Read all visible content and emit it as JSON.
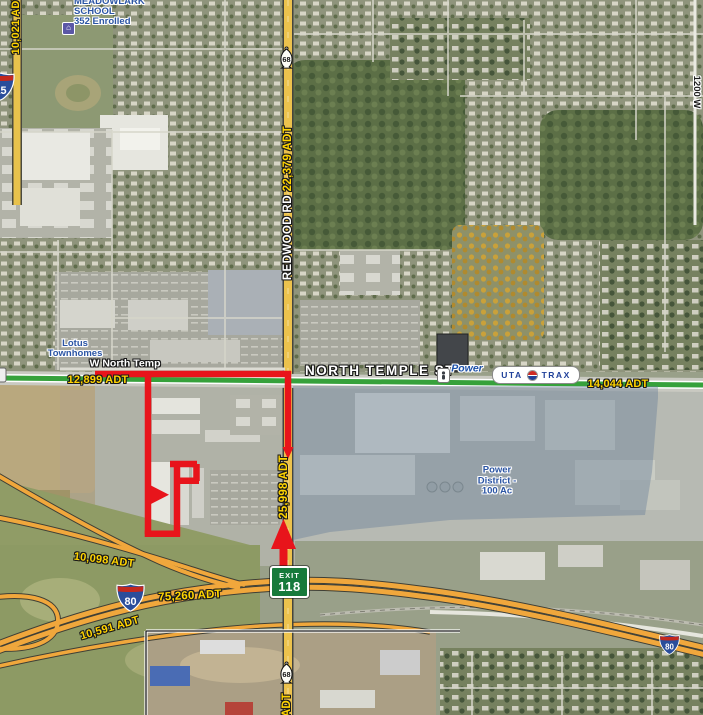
{
  "labels": {
    "school_1": "MEADOWLARK",
    "school_2": "SCHOOL",
    "school_3": "352 Enrolled",
    "lotus_1": "Lotus",
    "lotus_2": "Townhomes",
    "w_north_temp": "W North Temp",
    "north_temple": "NORTH TEMPLE ST",
    "redwood_rd": "REDWOOD RD",
    "power_stop": "Power",
    "uta": "UTA",
    "trax": "TRAX",
    "pd_1": "Power",
    "pd_2": "District -",
    "pd_3": "100 Ac",
    "street_1200w": "1200 W",
    "exit_word": "EXIT",
    "exit_num": "118",
    "i15": "15",
    "i80": "80",
    "ut68": "68"
  },
  "traffic_counts": {
    "left_road": "10,021 ADT",
    "redwood_north": "22,379 ADT",
    "redwood_south": "25,998 ADT",
    "redwood_bottom_partial": "ADT",
    "north_temple_west": "12,899 ADT",
    "north_temple_east": "14,044 ADT",
    "ramp_northwest": "10,098 ADT",
    "i80_mainline": "75,260 ADT",
    "frontage_road": "10,591 ADT"
  },
  "colors": {
    "adt_yellow": "#ffd400",
    "boundary_red": "#e8141b",
    "trax_green": "#36a13b",
    "road_yellow": "#ecc24d",
    "freeway_orange": "#f0a73c",
    "map_label_blue": "#2b55a4",
    "exit_sign_green": "#177a3b",
    "district_overlay": "rgba(96,120,150,0.38)"
  }
}
